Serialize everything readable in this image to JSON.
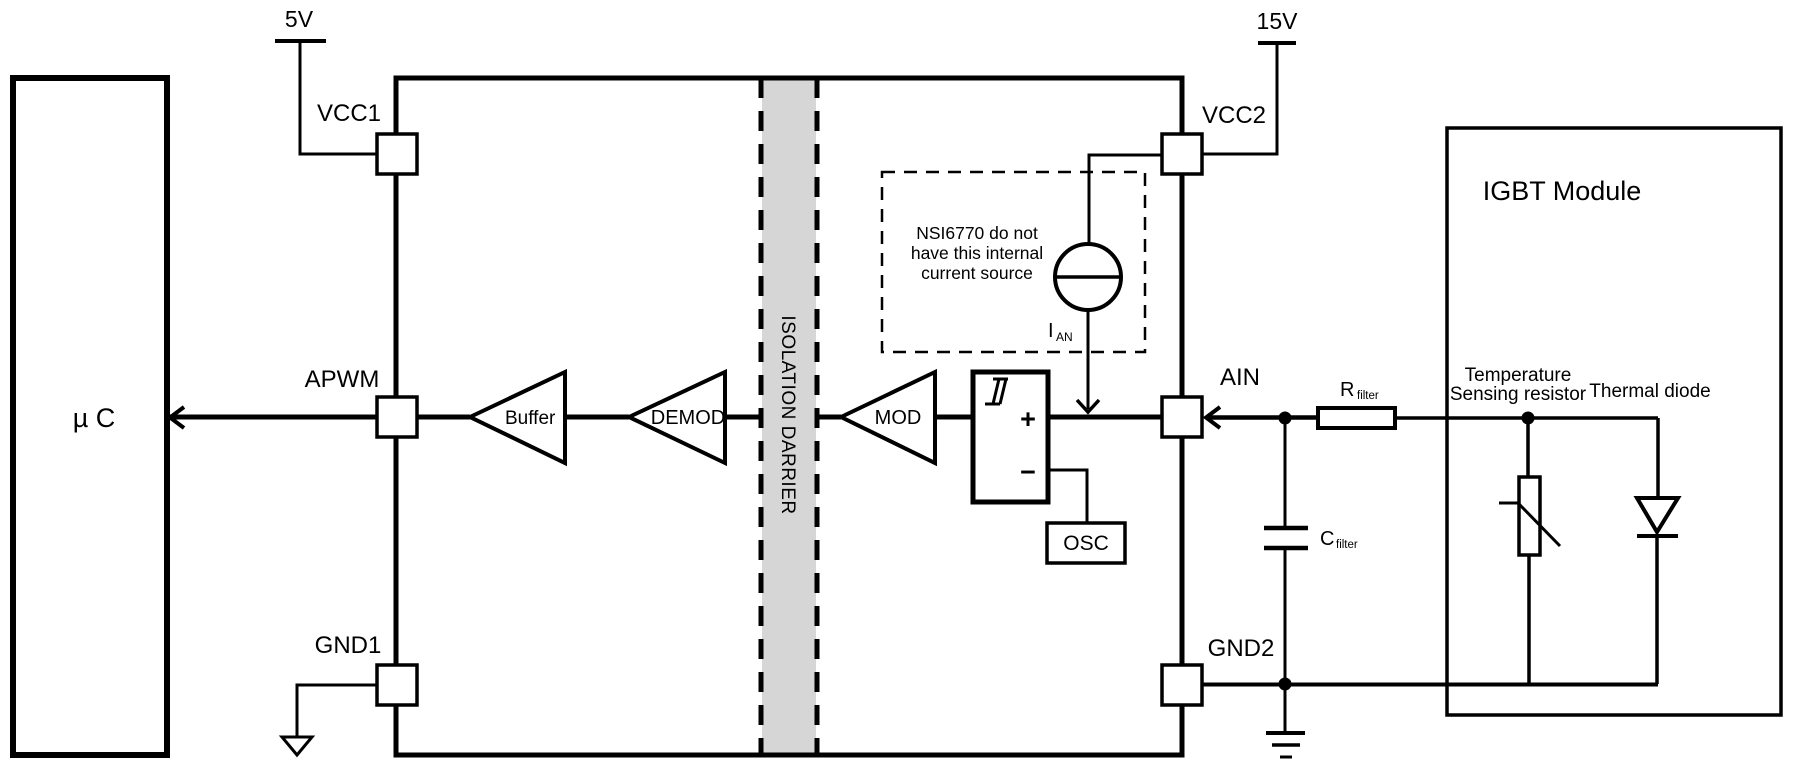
{
  "diagram": {
    "background": "#ffffff",
    "line_color": "#000000",
    "watermark": {
      "text": "NOVOSENSE",
      "color": "#e7e7e7"
    },
    "supplies": {
      "left": "5V",
      "right": "15V"
    },
    "mcu": {
      "label": "µ C"
    },
    "isolator": {
      "pins": {
        "vcc1": "VCC1",
        "apwm": "APWM",
        "gnd1": "GND1",
        "vcc2": "VCC2",
        "ain": "AIN",
        "gnd2": "GND2"
      },
      "blocks": {
        "buffer": "Buffer",
        "demod": "DEMOD",
        "mod": "MOD",
        "osc": "OSC"
      },
      "comparator": {
        "plus": "+",
        "minus": "−"
      },
      "barrier_label": "ISOLATION DARRIER",
      "barrier_fill": "#d6d6d6",
      "note": {
        "line1": "NSI6770 do not",
        "line2": "have this internal",
        "line3": "current source"
      },
      "current_source_label": {
        "base": "I",
        "sub": "AN"
      }
    },
    "filter": {
      "r": {
        "base": "R",
        "sub": "filter"
      },
      "c": {
        "base": "C",
        "sub": "filter"
      }
    },
    "igbt_module": {
      "title": "IGBT Module",
      "thermistor_label_line1": "Temperature",
      "thermistor_label_line2": "Sensing resistor",
      "diode_label": "Thermal diode"
    }
  }
}
